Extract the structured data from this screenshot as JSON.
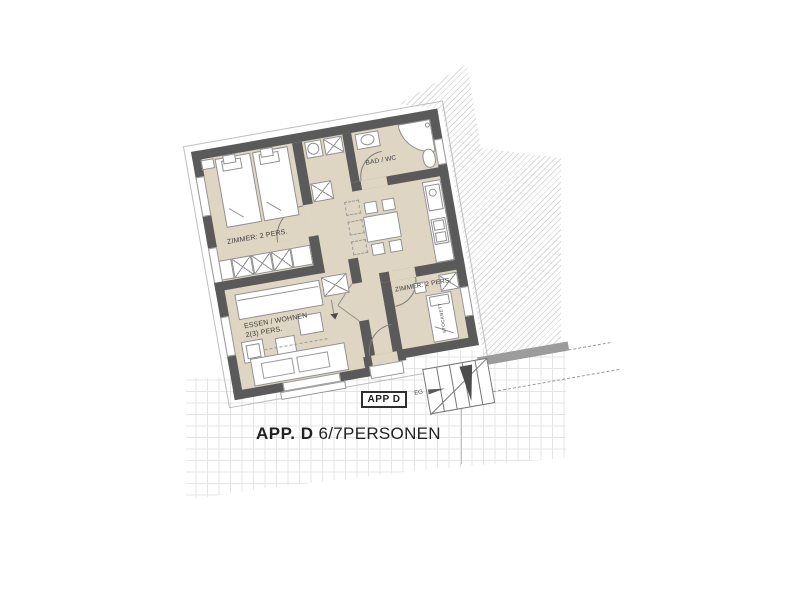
{
  "floorplan": {
    "title_bold": "APP. D",
    "title_regular": " 6/7PERSONEN",
    "marker_label": "APP D",
    "level_label": "EG",
    "rooms": {
      "bedroom_top": "ZIMMER: 2 PERS.",
      "bedroom_right": "ZIMMER: 2 PERS.",
      "bathroom": "BAD / WC",
      "living_line1": "ESSEN / WOHNEN",
      "living_line2": "2(3) PERS.",
      "bunk_bed": "STOCKBETT"
    },
    "colors": {
      "wall": "#5a5a5a",
      "floor": "#ded5c2",
      "hatch_line": "#dbdbdb",
      "grid_line": "#e4e4e4",
      "terrace_band": "#9c9c9c",
      "label_text": "#3c3c3c",
      "title_text": "#222222"
    }
  }
}
